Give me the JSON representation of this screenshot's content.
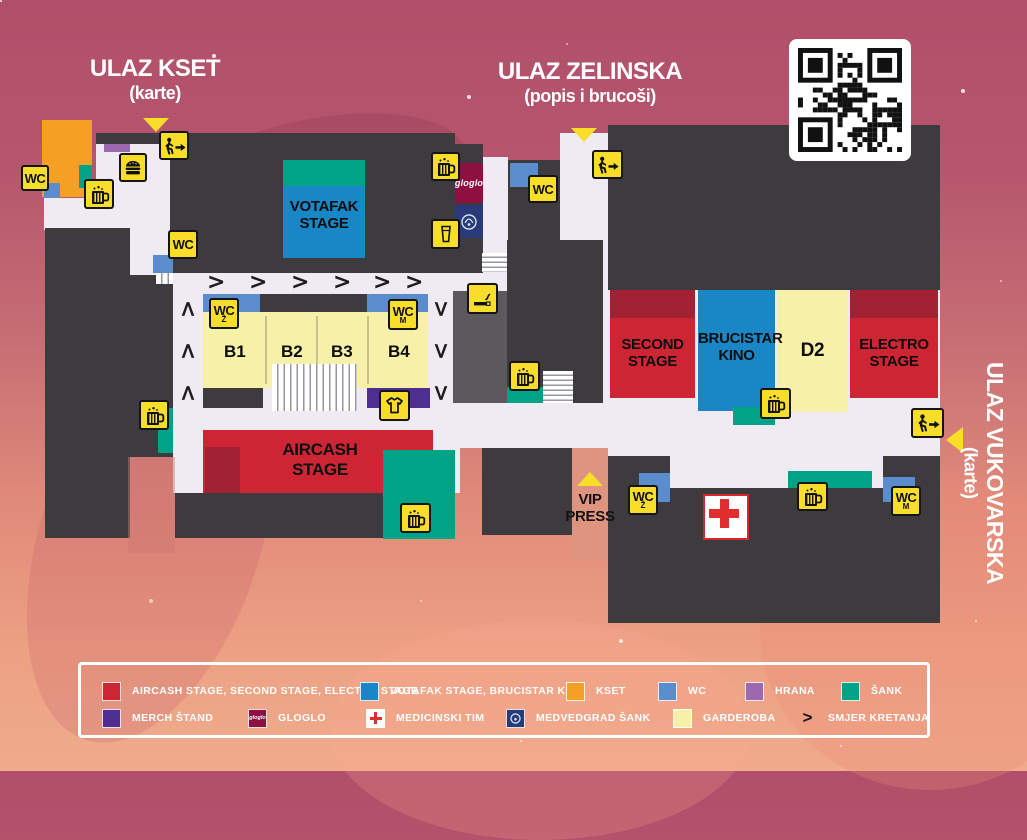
{
  "titles": {
    "kset": {
      "line1": "ULAZ KSET",
      "line2": "(karte)"
    },
    "zelinska": {
      "line1": "ULAZ ZELINSKA",
      "line2": "(popis i brucoši)"
    },
    "vukovarska": {
      "line1": "ULAZ VUKOVARSKA",
      "line2": "(karte)"
    },
    "vip": {
      "line1": "VIP",
      "line2": "PRESS"
    }
  },
  "stages": {
    "votafak": {
      "line1": "VOTAFAK",
      "line2": "STAGE"
    },
    "aircash": {
      "line1": "AIRCASH",
      "line2": "STAGE"
    },
    "second": {
      "line1": "SECOND",
      "line2": "STAGE"
    },
    "brucistar": {
      "line1": "BRUCISTAR",
      "line2": "KINO"
    },
    "d2": {
      "line1": "D2"
    },
    "electro": {
      "line1": "ELECTRO",
      "line2": "STAGE"
    }
  },
  "blocks": {
    "b1": "B1",
    "b2": "B2",
    "b3": "B3",
    "b4": "B4"
  },
  "labels": {
    "wc": "WC",
    "wc_female": "Ž",
    "wc_male": "M",
    "gloglo": "gloglo"
  },
  "icons": {
    "wc": "wc-sign",
    "beer_mug": "beer-mug",
    "beer_glass": "beer-glass",
    "burger": "food-burger",
    "exit": "walking-exit-arrow",
    "tshirt": "merch-tshirt",
    "cigarette": "smoking-area",
    "medical": "medical-red-cross",
    "qr": "qr-code",
    "direction": ">"
  },
  "colors": {
    "stage_red": "#cd2533",
    "stage_red_dark": "#a32134",
    "stage_blue": "#1987c5",
    "wc_blue": "#5b8ccd",
    "kset_orange": "#f4a024",
    "hrana_purple": "#9c68ae",
    "sank_teal": "#00a385",
    "merch_purple": "#4f2e92",
    "gloglo_red": "#8e1040",
    "medvedgrad_navy": "#2a3a78",
    "garderoba_cream": "#f6f0a8",
    "icon_yellow": "#f8dd2b",
    "building_dark": "#3d3b3e",
    "corridor_white": "#f0ebf3"
  },
  "legend": {
    "row1": [
      {
        "label": "AIRCASH STAGE, SECOND STAGE, ELECTRO STAGE",
        "color": "#cd2533"
      },
      {
        "label": "VOTAFAK STAGE, BRUCISTAR KINO",
        "color": "#1987c5"
      },
      {
        "label": "KSET",
        "color": "#f4a024"
      },
      {
        "label": "WC",
        "color": "#5b8ccd"
      },
      {
        "label": "HRANA",
        "color": "#9c68ae"
      },
      {
        "label": "ŠANK",
        "color": "#00a385"
      }
    ],
    "row2": [
      {
        "label": "MERCH ŠTAND",
        "color": "#4f2e92"
      },
      {
        "label": "GLOGLO",
        "color": "#8e1040",
        "swatch_text": "gloglo"
      },
      {
        "label": "MEDICINSKI TIM",
        "color": "#ffffff"
      },
      {
        "label": "MEDVEDGRAD ŠANK",
        "color": "#2a3a78"
      },
      {
        "label": "GARDEROBA",
        "color": "#f6f0a8"
      },
      {
        "label": "SMJER KRETANJA",
        "swatch_text": ">"
      }
    ]
  }
}
